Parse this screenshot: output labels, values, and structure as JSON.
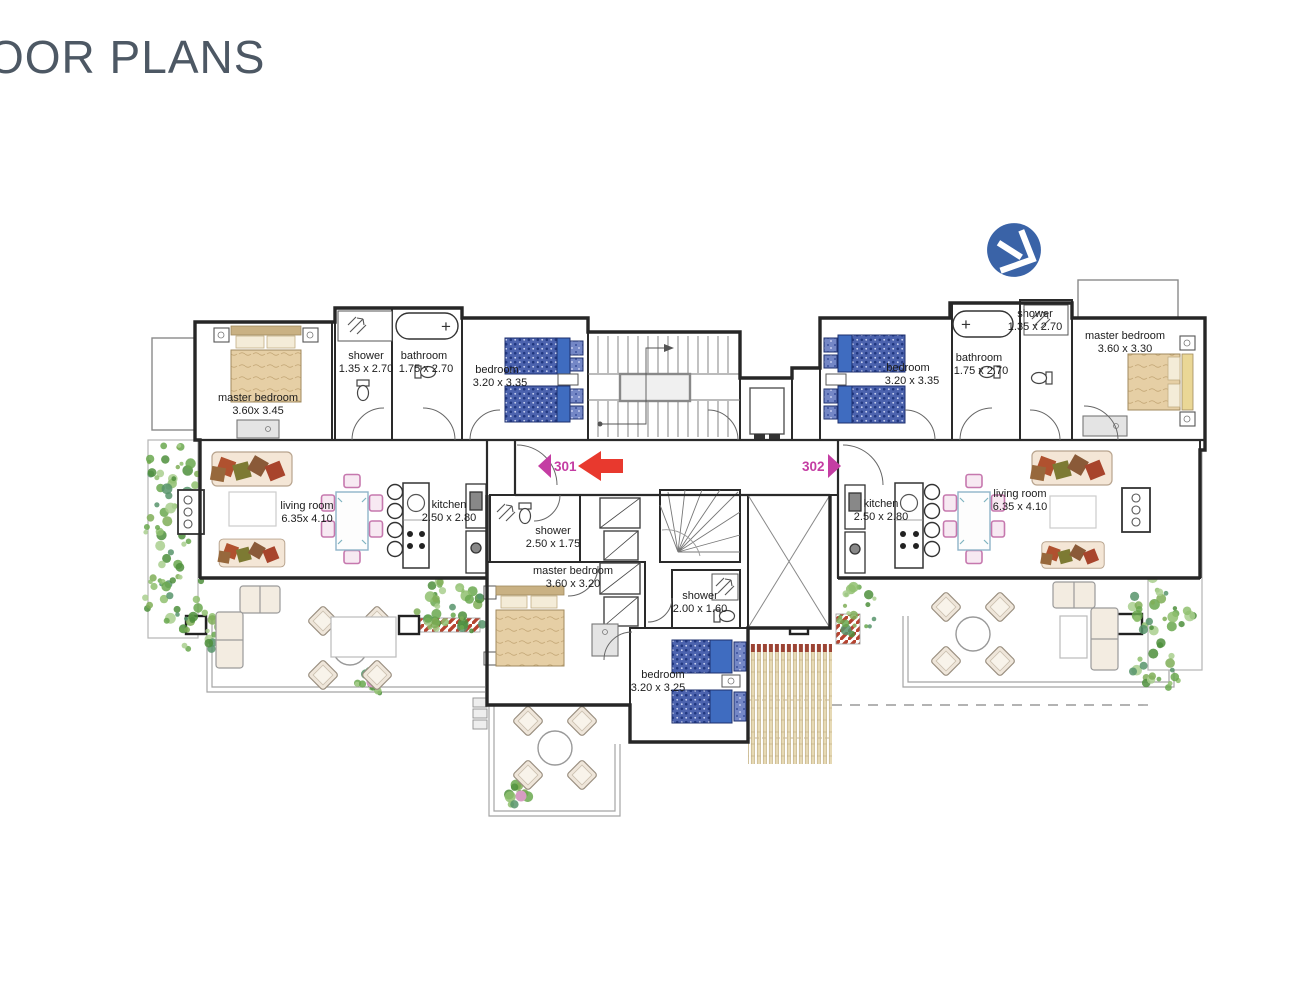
{
  "page": {
    "title": "OOR PLANS",
    "title_color": "#4d5864"
  },
  "logo": {
    "name": "developer-logo",
    "color": "#3a63a7"
  },
  "units": {
    "left": "301",
    "right": "302"
  },
  "icons": {
    "tub_plus": "+"
  },
  "rooms": {
    "l_master": {
      "label": "master bedroom",
      "dims": "3.60x 3.45"
    },
    "l_shower": {
      "label": "shower",
      "dims": "1.35 x 2.70"
    },
    "l_bath": {
      "label": "bathroom",
      "dims": "1.75 x 2.70"
    },
    "l_bedroom": {
      "label": "bedroom",
      "dims": "3.20 x 3.35"
    },
    "l_living": {
      "label": "living room",
      "dims": "6.35x 4.10"
    },
    "l_kitchen": {
      "label": "kitchen",
      "dims": "2.50 x 2.80"
    },
    "c_shower1": {
      "label": "shower",
      "dims": "2.50 x 1.75"
    },
    "c_master": {
      "label": "master bedroom",
      "dims": "3.60 x 3.20"
    },
    "c_shower2": {
      "label": "shower",
      "dims": "2.00 x 1.60"
    },
    "c_bedroom": {
      "label": "bedroom",
      "dims": "3.20 x 3.25"
    },
    "r_bedroom": {
      "label": "bedroom",
      "dims": "3.20 x 3.35"
    },
    "r_bath": {
      "label": "bathroom",
      "dims": "1.75 x 2.70"
    },
    "r_shower": {
      "label": "shower",
      "dims": "1.35 x 2.70"
    },
    "r_master": {
      "label": "master bedroom",
      "dims": "3.60 x 3.30"
    },
    "r_kitchen": {
      "label": "kitchen",
      "dims": "2.50 x 2.80"
    },
    "r_living": {
      "label": "living room",
      "dims": "6.35 x 4.10"
    }
  },
  "colors": {
    "unit_label": "#c43da3",
    "direction_arrow": "#e8392e",
    "bed_blue": "#4c63ae",
    "bed_tan": "#e6cfa5",
    "chair_pink": "#c678ae",
    "plant_green": "#6aa84f",
    "wall": "#262626"
  }
}
